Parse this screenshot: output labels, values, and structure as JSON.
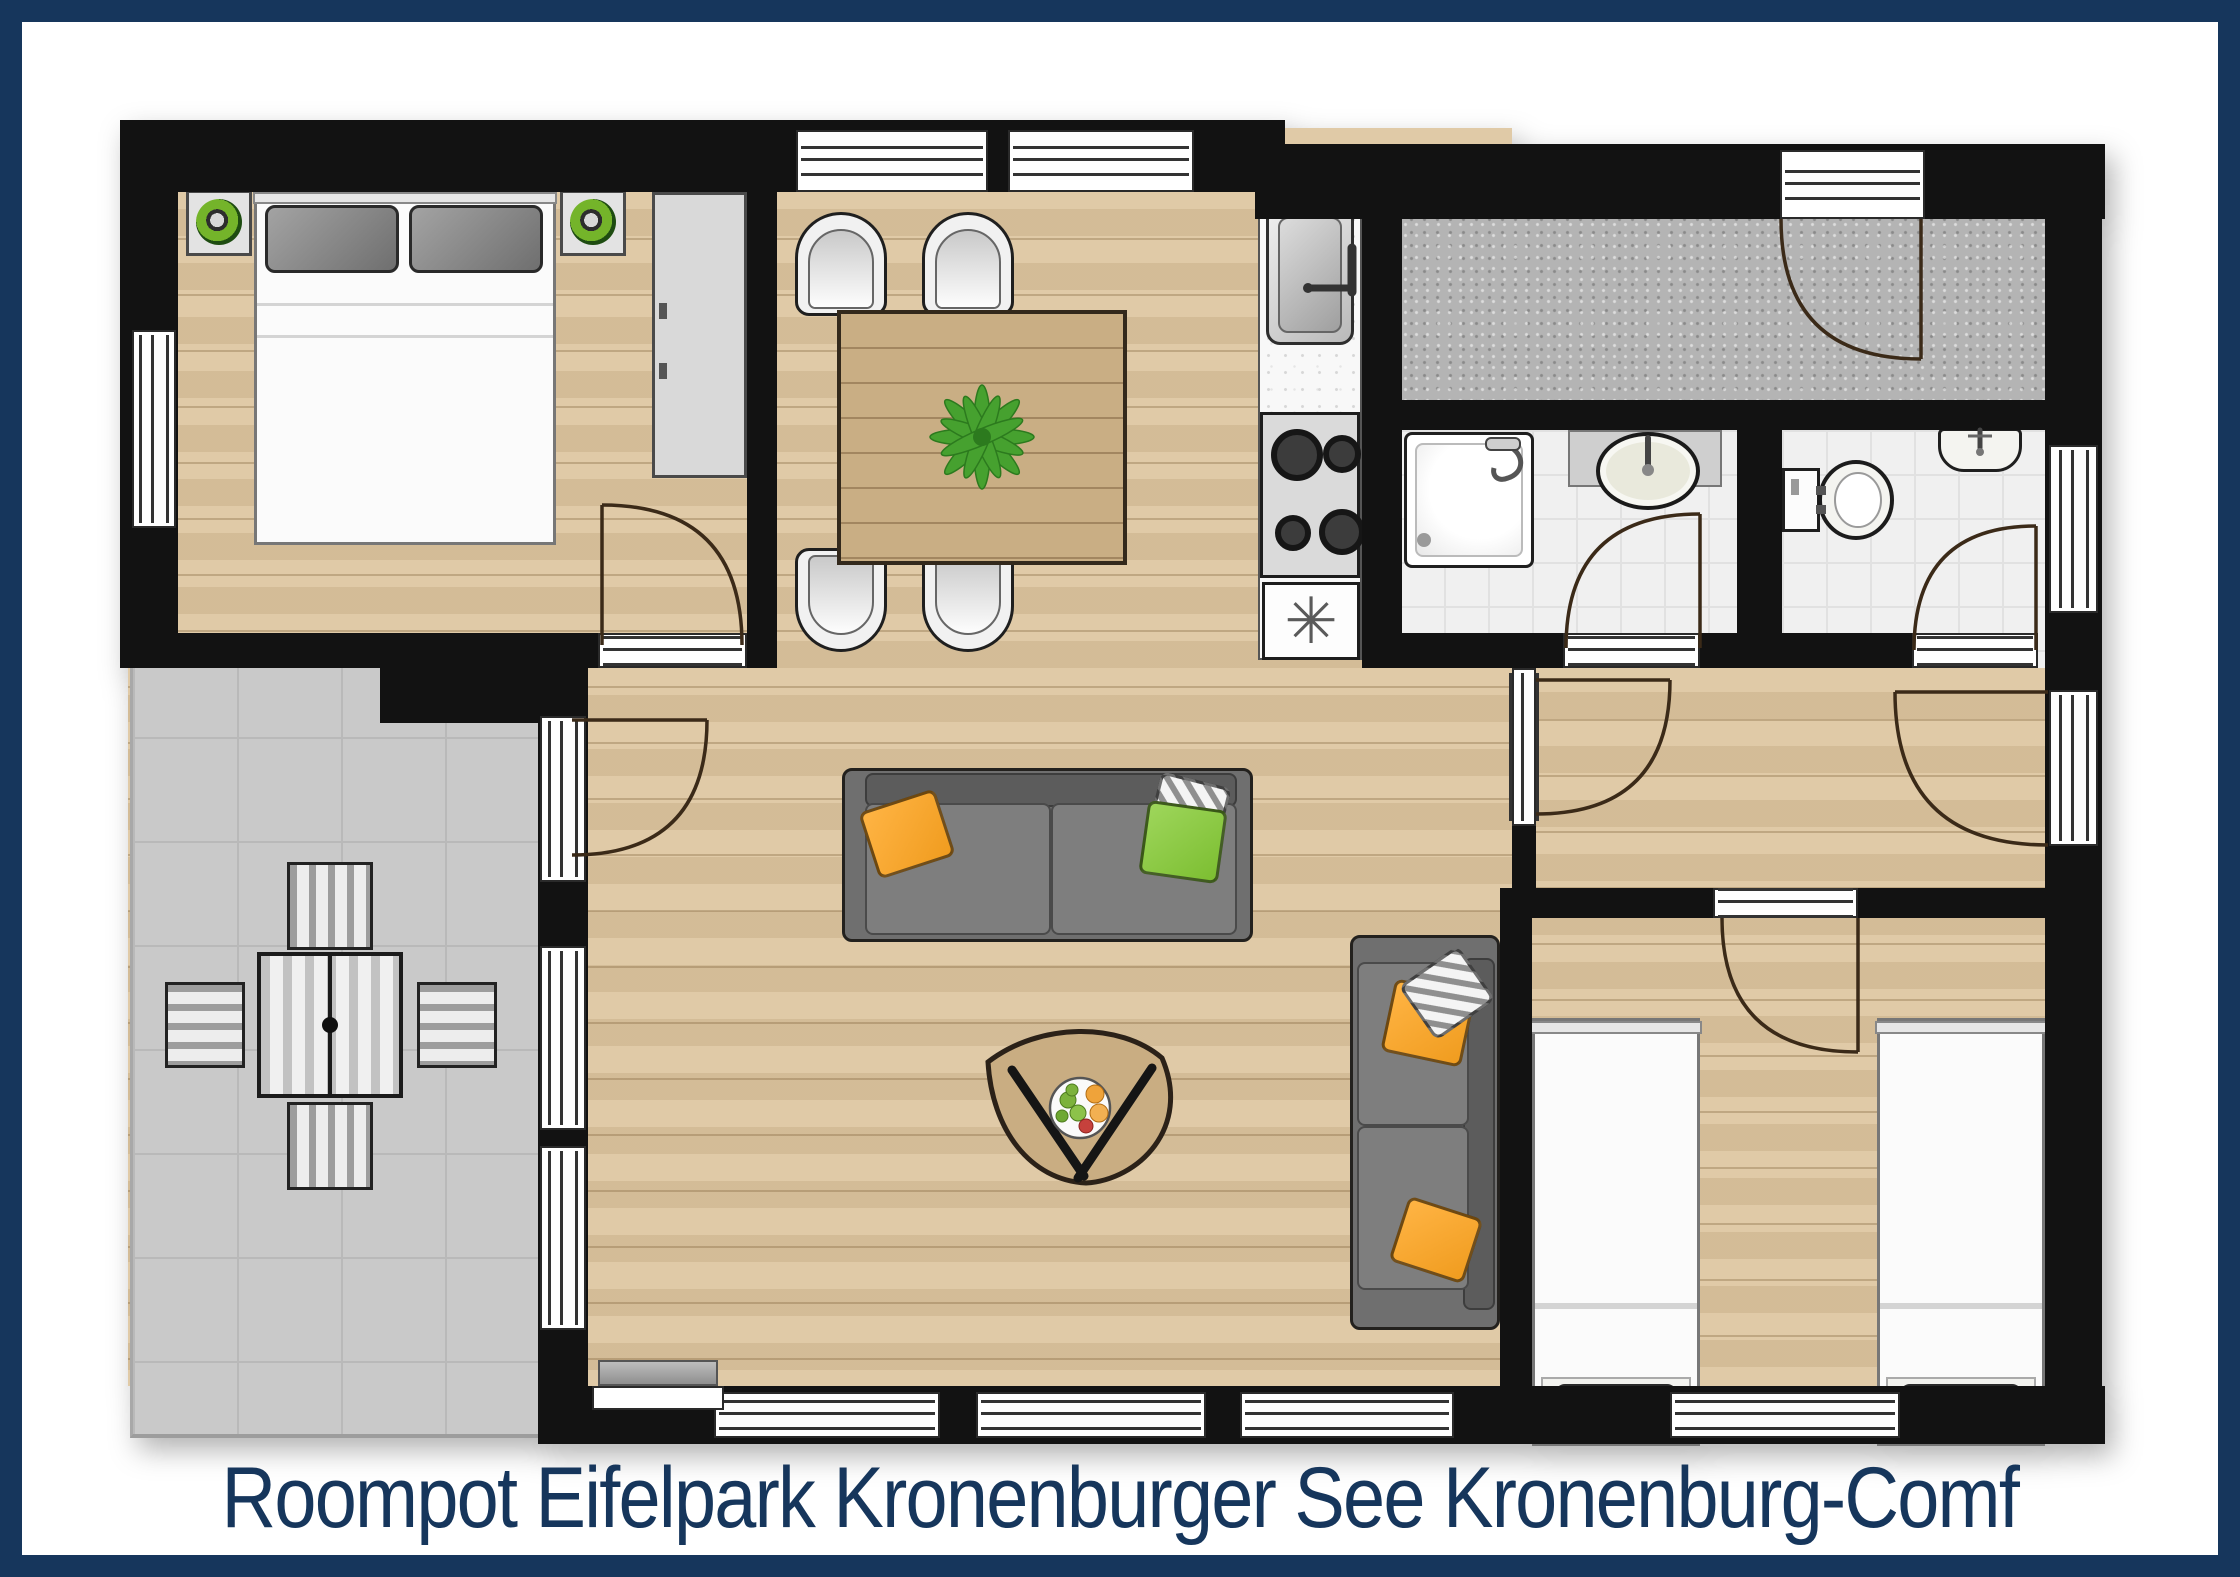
{
  "caption": {
    "text": "Roompot Eifelpark Kronenburger See Kronenburg-Comf"
  },
  "icons": {
    "freezer_symbol": "✳"
  },
  "colors": {
    "frame_navy": "#16365c",
    "caption": "#16365c",
    "wall": "#121212",
    "wood": "#dcc49d",
    "twood": "#c9ae84",
    "terrace": "#c9c9c9",
    "hall": "#b4b4b4",
    "tile": "#f0f0f0",
    "sofa": "#6f6f6f",
    "orange": "#f09c1f",
    "green": "#7cbe31",
    "lampg": "#74b42a"
  },
  "rooms": [
    {
      "name": "master-bedroom",
      "furniture": [
        "double-bed",
        "nightstand-with-lamp",
        "nightstand-with-lamp",
        "wardrobe"
      ]
    },
    {
      "name": "dining-area",
      "furniture": [
        "dining-table",
        "potted-plant",
        "chair",
        "chair",
        "chair",
        "chair"
      ]
    },
    {
      "name": "kitchen",
      "furniture": [
        "kitchen-sink",
        "gas-hob",
        "freezer"
      ]
    },
    {
      "name": "entrance-hall",
      "furniture": []
    },
    {
      "name": "bathroom",
      "furniture": [
        "shower",
        "washbasin"
      ]
    },
    {
      "name": "toilet-room",
      "furniture": [
        "toilet",
        "hand-basin"
      ]
    },
    {
      "name": "hallway",
      "furniture": []
    },
    {
      "name": "living-room",
      "furniture": [
        "sofa-large",
        "sofa-small",
        "coffee-table",
        "fruit-bowl",
        "doormat"
      ]
    },
    {
      "name": "twin-bedroom",
      "furniture": [
        "single-bed",
        "single-bed"
      ]
    },
    {
      "name": "terrace",
      "furniture": [
        "outdoor-table",
        "outdoor-chair",
        "outdoor-chair",
        "outdoor-chair",
        "outdoor-chair"
      ]
    }
  ],
  "openings": {
    "windows": 12,
    "doors": 8
  }
}
